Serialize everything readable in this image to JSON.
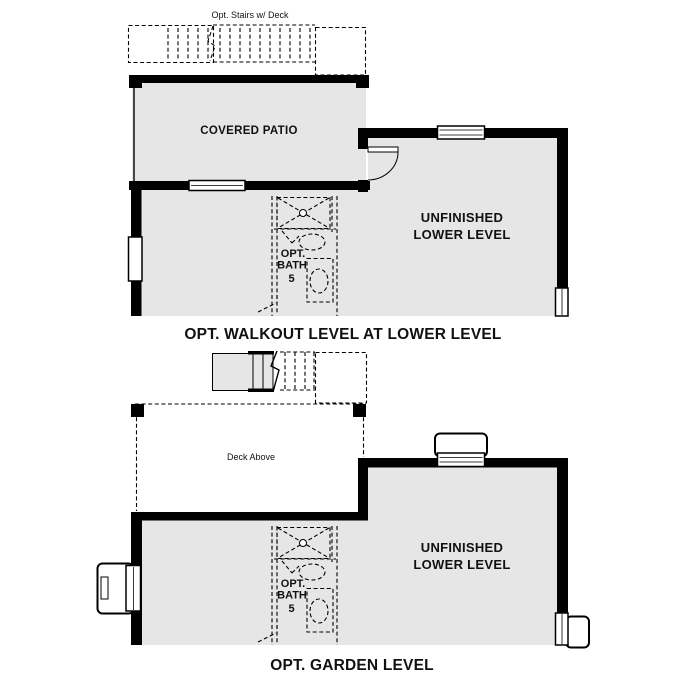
{
  "colors": {
    "wall": "#000000",
    "room-fill": "#e6e6e6",
    "line": "#000000",
    "text": "#111111",
    "bg": "#ffffff"
  },
  "plan_walkout": {
    "stairs_label": "Opt. Stairs w/ Deck",
    "patio_label": "COVERED PATIO",
    "room_label_line1": "UNFINISHED",
    "room_label_line2": "LOWER LEVEL",
    "bath_label_line1": "OPT.",
    "bath_label_line2": "BATH",
    "bath_label_line3": "5",
    "title": "OPT. WALKOUT LEVEL AT LOWER LEVEL"
  },
  "plan_garden": {
    "deck_label": "Deck Above",
    "room_label_line1": "UNFINISHED",
    "room_label_line2": "LOWER LEVEL",
    "bath_label_line1": "OPT.",
    "bath_label_line2": "BATH",
    "bath_label_line3": "5",
    "title": "OPT. GARDEN LEVEL"
  }
}
